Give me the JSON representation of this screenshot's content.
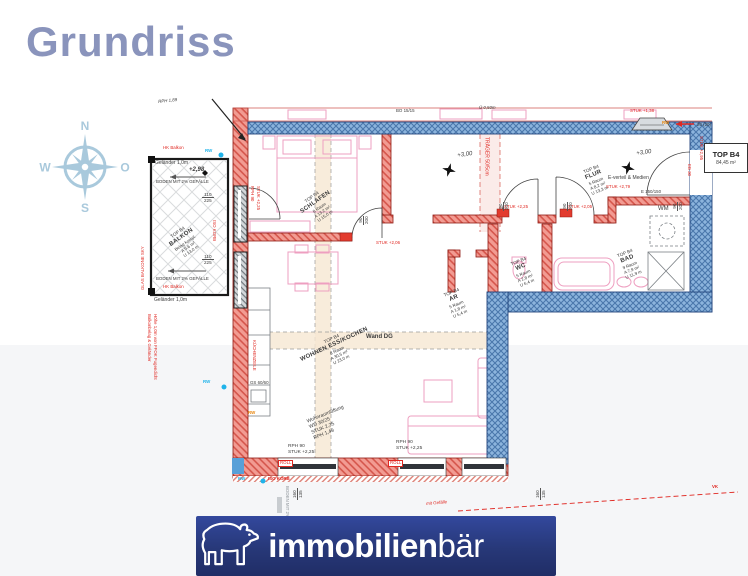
{
  "title": "Grundriss",
  "compass": {
    "n": "N",
    "o": "O",
    "s": "S",
    "w": "W"
  },
  "colors": {
    "title": "#8a94bc",
    "wall_red": "#f29b92",
    "wall_blue": "#8cb4dd",
    "accent_red": "#e02822",
    "cyan": "#1fb3ea",
    "orange": "#e8860d",
    "furniture_pink": "#ee9fc0",
    "logo_navy": "#273878"
  },
  "balcony": {
    "hk_top": "HK Balkon",
    "railing_top": "Geländer 1,0m",
    "level": "+2,98",
    "slope_top": "BODEN MIT 2% GEFÄLLE",
    "slope_bottom": "BODEN MIT 2% GEFÄLLE",
    "hk_bottom": "HK Balkon",
    "railing_bottom": "Geländer 1,0m",
    "glas": "GLAS BALKONE SKY",
    "note1": "Balkonbelag & Geländer",
    "note2": "Höhe 1,0m von FFOK Fugendicht",
    "dim_w": "110",
    "dim_h": "225",
    "room": {
      "top": "TOP B4",
      "name": "BALKON",
      "l1": "Belag kompl.",
      "l2": "A 9,6 m²",
      "l3": "U 13,0 m"
    }
  },
  "rooms": {
    "schlafen": {
      "top": "TOP B4",
      "name": "SCHLAFEN",
      "l1": "8 Raum",
      "l2": "A 13,2 m²",
      "l3": "U 15,0 m"
    },
    "flur": {
      "top": "TOP B4",
      "name": "FLUR",
      "l1": "5 Raum",
      "l2": "A 8,2 m²",
      "l3": "U 13,3 m"
    },
    "wc": {
      "top": "TOP B4",
      "name": "WC",
      "l1": "5 Raum",
      "l2": "A 2,8 m²",
      "l3": "U 6,4 m"
    },
    "ar": {
      "top": "TOP B4",
      "name": "AR",
      "l1": "5 Raum",
      "l2": "A 1,8 m²",
      "l3": "U 5,4 m"
    },
    "bad": {
      "top": "TOP B4",
      "name": "BAD",
      "l1": "9 Raum",
      "l2": "A 7,9 m²",
      "l3": "U 11,9 m"
    },
    "wohnen": {
      "top": "TOP B4",
      "name": "WOHNEN ESS/KOCHEN",
      "l1": "8 Raum",
      "l2": "A 30,5 m²",
      "l3": "U 23,0 m"
    },
    "wm": "WM"
  },
  "unit": {
    "name": "TOP B4",
    "area": "84,45 m²"
  },
  "ann": {
    "rph189": "RPH 1,89",
    "bo1515": "BO 15/15",
    "ue": "Ü 0,50m",
    "stuk138": "STUK +1,38",
    "rw": "RW",
    "dim2020": "20 (20)",
    "stuk295": "STUK +2,95",
    "eb30": "EB 30",
    "level300": "+3,00",
    "traeger": "TRÄGER 50/5cm",
    "rph90": "RPH 90",
    "stuk225": "STUK +2,25",
    "stuk206": "STUK +2,06",
    "stuk205": "STUK +2,05",
    "stuk279": "STUK +2,79",
    "d90": "90",
    "d200": "200",
    "wand_dg": "Wand DG",
    "everteil": "E-verteil & Medien",
    "e150": "E 150/150",
    "kueche": "KÜCHENZEILE",
    "gs": "GS 60/60",
    "lueft1": "Wohnraumlüftung",
    "lueft2": "WD 30/25",
    "lueft3": "STUK 2,25",
    "lueft4": "RPH 1,49",
    "roll": "ROLL",
    "iso_korb": "ISO KORB",
    "boden_v": "BODEN MIT 2%",
    "d160": "160",
    "d135": "135",
    "gefaelle": "mit Gefälle",
    "vk": "VK"
  },
  "logo": {
    "bold": "immobilien",
    "light": "bär"
  }
}
